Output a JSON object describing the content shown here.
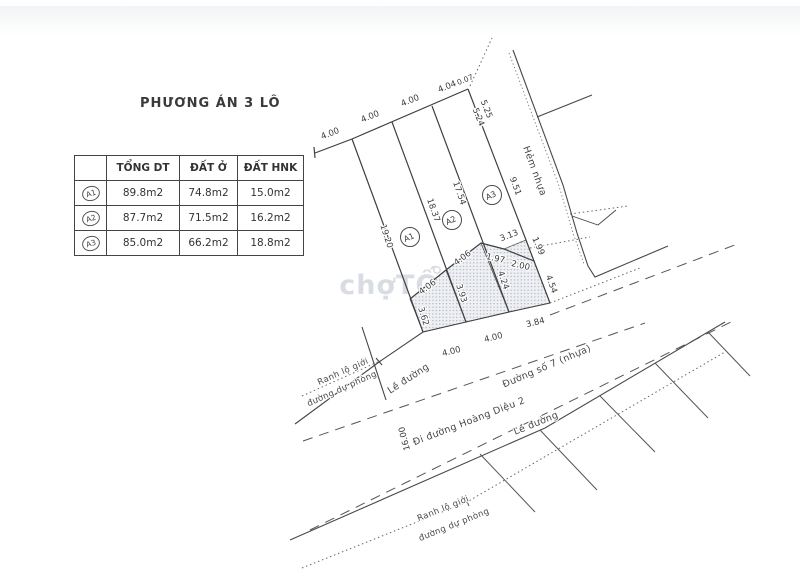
{
  "title": "PHƯƠNG ÁN 3 LÔ",
  "watermark": "chợTỐT",
  "table": {
    "headers": [
      "",
      "TỔNG DT",
      "ĐẤT Ở",
      "ĐẤT HNK"
    ],
    "rows": [
      {
        "id": "A1",
        "tong": "89.8m2",
        "o": "74.8m2",
        "hnk": "15.0m2"
      },
      {
        "id": "A2",
        "tong": "87.7m2",
        "o": "71.5m2",
        "hnk": "16.2m2"
      },
      {
        "id": "A3",
        "tong": "85.0m2",
        "o": "66.2m2",
        "hnk": "18.8m2"
      }
    ]
  },
  "lots": {
    "a1": "A1",
    "a2": "A2",
    "a3": "A3"
  },
  "dims": {
    "top_outside": "4.00",
    "top_a1": "4.00",
    "top_a2": "4.00",
    "top_a3": "4.04",
    "top_corner": "0.07",
    "east_upper_outer": "5.25",
    "east_upper_inner": "5.24",
    "east_lower": "9.51",
    "side_a1_left": "19.20",
    "side_div12": "18.37",
    "side_div23": "17.54",
    "hnk_a1_top": "4.06",
    "hnk_a2_top": "4.06",
    "hnk_a3_top_1": "1.97",
    "hnk_a3_top_2": "2.00",
    "tri_hyp": "3.13",
    "tri_side": "1.99",
    "hnk_a1_left": "3.62",
    "hnk_div12": "3.93",
    "hnk_div23": "4.24",
    "hnk_a3_right": "4.54",
    "front_a1": "4.00",
    "front_a2": "4.00",
    "front_a3": "3.84",
    "road_width": "16.00"
  },
  "labels": {
    "alley": "Hẻm nhựa",
    "curb_north": "Lề đường",
    "curb_south": "Lề đường",
    "road_direction": "Đi đường Hoàng Diệu 2",
    "road_name": "Đường số 7 (nhựa)",
    "boundary_north_line1": "Ranh lộ giới",
    "boundary_north_line2": "đường dự phòng",
    "boundary_south_line1": "Ranh lộ giới",
    "boundary_south_line2": "đường dự phòng"
  }
}
